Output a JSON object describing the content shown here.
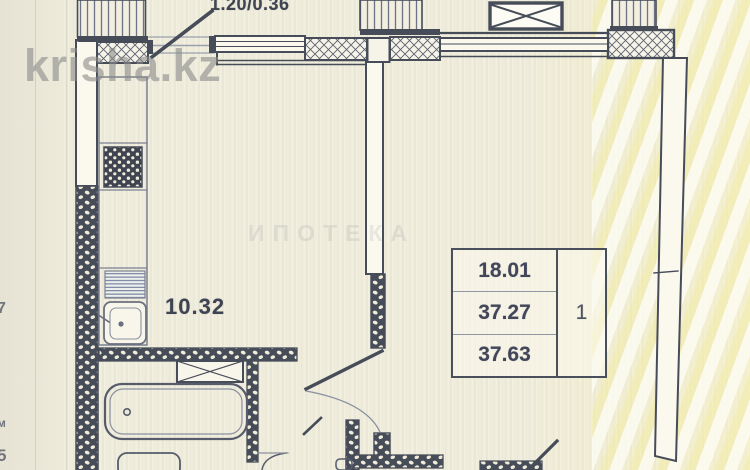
{
  "watermarks": {
    "brand": "krisha.kz",
    "center_text": "ИПОТЕКА"
  },
  "plan": {
    "top_dimension": "1.20/0.36",
    "kitchen_area": "10.32",
    "area_table": {
      "values": [
        "18.01",
        "37.27",
        "37.63"
      ],
      "room_count": "1"
    },
    "edge_marks": [
      "7",
      "м",
      "5"
    ]
  },
  "colors": {
    "paper": "#efecd9",
    "ink": "#474c59",
    "watermark_gray": "#8a8a8a",
    "stripe_yellow": "#f2eb9b"
  }
}
